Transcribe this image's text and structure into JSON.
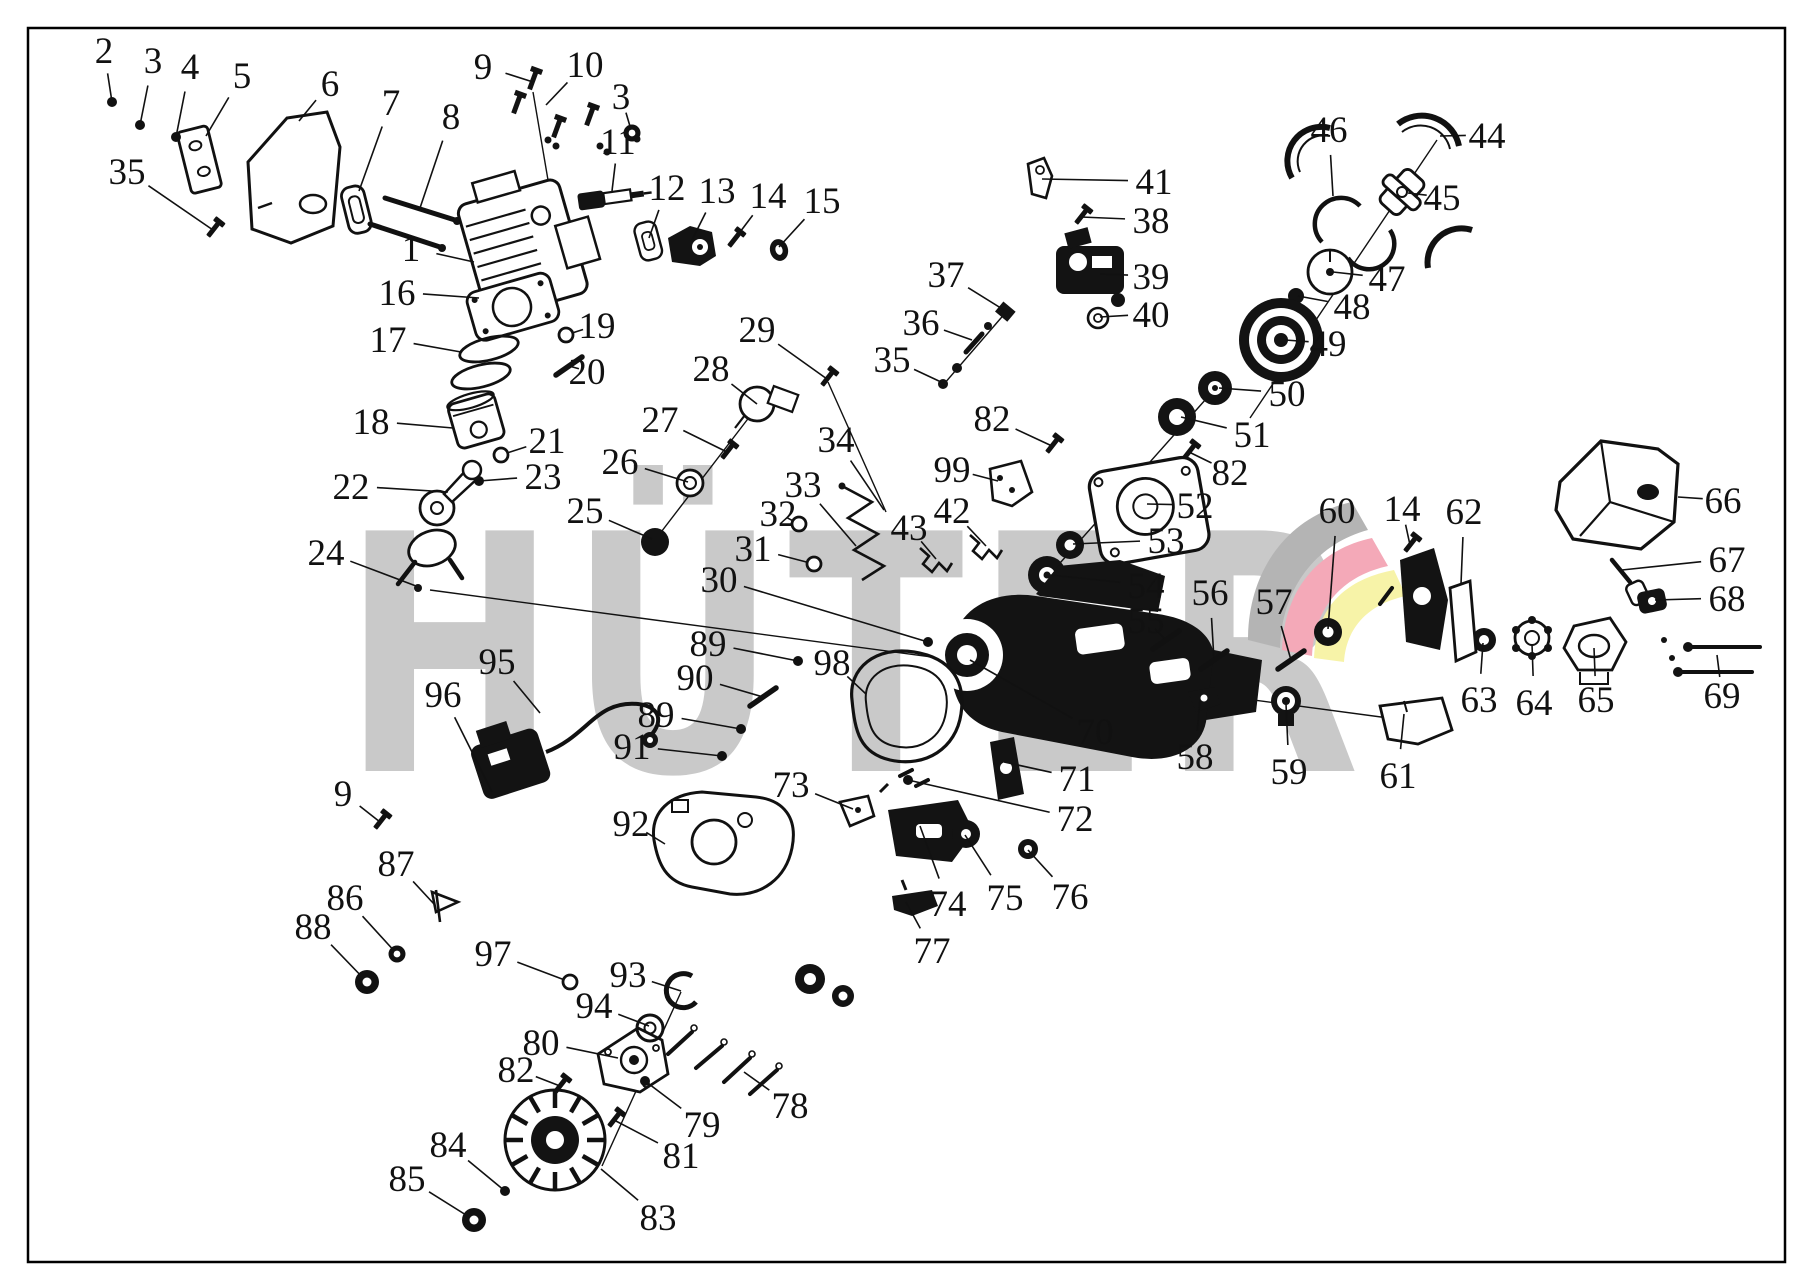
{
  "watermark": {
    "text": "HÜTER",
    "color": "#c9c9c9"
  },
  "logo": {
    "gray": "#b4b4b4",
    "pink": "#f4a9b8",
    "yellow": "#f7f3a8"
  },
  "frame": {
    "color": "#000000"
  },
  "ink": "#111111",
  "callouts": [
    {
      "n": "1",
      "x": 411,
      "y": 248,
      "tx": 474,
      "ty": 262,
      "g": "none"
    },
    {
      "n": "2",
      "x": 104,
      "y": 50,
      "tx": 112,
      "ty": 102,
      "g": "dot"
    },
    {
      "n": "3",
      "x": 153,
      "y": 60,
      "tx": 140,
      "ty": 125,
      "g": "dot"
    },
    {
      "n": "3",
      "x": 621,
      "y": 96,
      "tx": 632,
      "ty": 133,
      "g": "washer"
    },
    {
      "n": "4",
      "x": 190,
      "y": 66,
      "tx": 176,
      "ty": 137,
      "g": "dot"
    },
    {
      "n": "5",
      "x": 242,
      "y": 75,
      "tx": 206,
      "ty": 136,
      "g": "none"
    },
    {
      "n": "6",
      "x": 330,
      "y": 83,
      "tx": 299,
      "ty": 121,
      "g": "none"
    },
    {
      "n": "7",
      "x": 391,
      "y": 102,
      "tx": 359,
      "ty": 191,
      "g": "none"
    },
    {
      "n": "8",
      "x": 451,
      "y": 116,
      "tx": 420,
      "ty": 208,
      "g": "none"
    },
    {
      "n": "9",
      "x": 483,
      "y": 66,
      "tx": 533,
      "ty": 82,
      "g": "none"
    },
    {
      "n": "9",
      "x": 343,
      "y": 793,
      "tx": 380,
      "ty": 822,
      "g": "bolt"
    },
    {
      "n": "10",
      "x": 585,
      "y": 64,
      "tx": 546,
      "ty": 105,
      "g": "none"
    },
    {
      "n": "11",
      "x": 618,
      "y": 141,
      "tx": 612,
      "ty": 191,
      "g": "none"
    },
    {
      "n": "12",
      "x": 667,
      "y": 187,
      "tx": 649,
      "ty": 238,
      "g": "none"
    },
    {
      "n": "13",
      "x": 717,
      "y": 190,
      "tx": 692,
      "ty": 240,
      "g": "none"
    },
    {
      "n": "14",
      "x": 768,
      "y": 195,
      "tx": 734,
      "ty": 240,
      "g": "bolt"
    },
    {
      "n": "14",
      "x": 1402,
      "y": 508,
      "tx": 1410,
      "ty": 545,
      "g": "bolt"
    },
    {
      "n": "15",
      "x": 822,
      "y": 200,
      "tx": 779,
      "ty": 247,
      "g": "none"
    },
    {
      "n": "16",
      "x": 397,
      "y": 292,
      "tx": 479,
      "ty": 298,
      "g": "none"
    },
    {
      "n": "17",
      "x": 388,
      "y": 339,
      "tx": 461,
      "ty": 352,
      "g": "none"
    },
    {
      "n": "18",
      "x": 371,
      "y": 421,
      "tx": 453,
      "ty": 428,
      "g": "none"
    },
    {
      "n": "19",
      "x": 597,
      "y": 325,
      "tx": 566,
      "ty": 335,
      "g": "ring"
    },
    {
      "n": "20",
      "x": 587,
      "y": 371,
      "tx": 569,
      "ty": 366,
      "g": "rod"
    },
    {
      "n": "21",
      "x": 547,
      "y": 440,
      "tx": 501,
      "ty": 455,
      "g": "ring"
    },
    {
      "n": "22",
      "x": 351,
      "y": 486,
      "tx": 448,
      "ty": 492,
      "g": "none"
    },
    {
      "n": "23",
      "x": 543,
      "y": 476,
      "tx": 479,
      "ty": 481,
      "g": "dot"
    },
    {
      "n": "24",
      "x": 326,
      "y": 552,
      "tx": 416,
      "ty": 586,
      "g": "none"
    },
    {
      "n": "25",
      "x": 585,
      "y": 510,
      "tx": 652,
      "ty": 539,
      "g": "none"
    },
    {
      "n": "26",
      "x": 620,
      "y": 461,
      "tx": 688,
      "ty": 482,
      "g": "none"
    },
    {
      "n": "27",
      "x": 660,
      "y": 419,
      "tx": 727,
      "ty": 452,
      "g": "bolt"
    },
    {
      "n": "28",
      "x": 711,
      "y": 368,
      "tx": 757,
      "ty": 404,
      "g": "none"
    },
    {
      "n": "29",
      "x": 757,
      "y": 329,
      "tx": 827,
      "ty": 379,
      "g": "bolt"
    },
    {
      "n": "30",
      "x": 719,
      "y": 579,
      "tx": 928,
      "ty": 642,
      "g": "dot"
    },
    {
      "n": "31",
      "x": 753,
      "y": 548,
      "tx": 814,
      "ty": 564,
      "g": "ring"
    },
    {
      "n": "32",
      "x": 778,
      "y": 513,
      "tx": 799,
      "ty": 524,
      "g": "ring"
    },
    {
      "n": "33",
      "x": 803,
      "y": 484,
      "tx": 856,
      "ty": 546,
      "g": "none"
    },
    {
      "n": "34",
      "x": 836,
      "y": 439,
      "tx": 884,
      "ty": 510,
      "g": "none"
    },
    {
      "n": "35",
      "x": 127,
      "y": 171,
      "tx": 213,
      "ty": 230,
      "g": "bolt"
    },
    {
      "n": "35",
      "x": 892,
      "y": 359,
      "tx": 941,
      "ty": 382,
      "g": "none"
    },
    {
      "n": "36",
      "x": 921,
      "y": 322,
      "tx": 972,
      "ty": 340,
      "g": "none"
    },
    {
      "n": "37",
      "x": 946,
      "y": 274,
      "tx": 1004,
      "ty": 310,
      "g": "none"
    },
    {
      "n": "38",
      "x": 1151,
      "y": 220,
      "tx": 1081,
      "ty": 217,
      "g": "bolt"
    },
    {
      "n": "39",
      "x": 1151,
      "y": 276,
      "tx": 1100,
      "ty": 274,
      "g": "none"
    },
    {
      "n": "40",
      "x": 1151,
      "y": 314,
      "tx": 1100,
      "ty": 317,
      "g": "none"
    },
    {
      "n": "41",
      "x": 1154,
      "y": 181,
      "tx": 1042,
      "ty": 179,
      "g": "none"
    },
    {
      "n": "42",
      "x": 952,
      "y": 510,
      "tx": 986,
      "ty": 546,
      "g": "spring"
    },
    {
      "n": "43",
      "x": 909,
      "y": 527,
      "tx": 936,
      "ty": 559,
      "g": "spring"
    },
    {
      "n": "44",
      "x": 1487,
      "y": 135,
      "tx": 1440,
      "ty": 136,
      "g": "none"
    },
    {
      "n": "45",
      "x": 1442,
      "y": 197,
      "tx": 1408,
      "ty": 193,
      "g": "none"
    },
    {
      "n": "46",
      "x": 1329,
      "y": 129,
      "tx": 1333,
      "ty": 196,
      "g": "none"
    },
    {
      "n": "47",
      "x": 1387,
      "y": 278,
      "tx": 1333,
      "ty": 272,
      "g": "none"
    },
    {
      "n": "48",
      "x": 1352,
      "y": 306,
      "tx": 1298,
      "ty": 296,
      "g": "none"
    },
    {
      "n": "49",
      "x": 1328,
      "y": 343,
      "tx": 1285,
      "ty": 340,
      "g": "none"
    },
    {
      "n": "50",
      "x": 1287,
      "y": 393,
      "tx": 1219,
      "ty": 388,
      "g": "none"
    },
    {
      "n": "51",
      "x": 1252,
      "y": 434,
      "tx": 1181,
      "ty": 417,
      "g": "none"
    },
    {
      "n": "52",
      "x": 1195,
      "y": 505,
      "tx": 1147,
      "ty": 504,
      "g": "none"
    },
    {
      "n": "53",
      "x": 1166,
      "y": 540,
      "tx": 1073,
      "ty": 544,
      "g": "none"
    },
    {
      "n": "54",
      "x": 1146,
      "y": 585,
      "tx": 1050,
      "ty": 575,
      "g": "none"
    },
    {
      "n": "55",
      "x": 1146,
      "y": 620,
      "tx": 1166,
      "ty": 640,
      "g": "rod"
    },
    {
      "n": "56",
      "x": 1210,
      "y": 592,
      "tx": 1214,
      "ty": 660,
      "g": "rod"
    },
    {
      "n": "57",
      "x": 1274,
      "y": 601,
      "tx": 1291,
      "ty": 660,
      "g": "rod"
    },
    {
      "n": "58",
      "x": 1195,
      "y": 756,
      "tx": 1200,
      "ty": 700,
      "g": "none"
    },
    {
      "n": "59",
      "x": 1289,
      "y": 771,
      "tx": 1286,
      "ty": 704,
      "g": "none"
    },
    {
      "n": "60",
      "x": 1337,
      "y": 510,
      "tx": 1328,
      "ty": 629,
      "g": "none"
    },
    {
      "n": "61",
      "x": 1398,
      "y": 775,
      "tx": 1404,
      "ty": 714,
      "g": "none"
    },
    {
      "n": "62",
      "x": 1464,
      "y": 511,
      "tx": 1461,
      "ty": 584,
      "g": "none"
    },
    {
      "n": "63",
      "x": 1479,
      "y": 699,
      "tx": 1483,
      "ty": 643,
      "g": "none"
    },
    {
      "n": "64",
      "x": 1534,
      "y": 702,
      "tx": 1532,
      "ty": 644,
      "g": "none"
    },
    {
      "n": "65",
      "x": 1596,
      "y": 699,
      "tx": 1594,
      "ty": 648,
      "g": "none"
    },
    {
      "n": "66",
      "x": 1723,
      "y": 500,
      "tx": 1678,
      "ty": 497,
      "g": "none"
    },
    {
      "n": "67",
      "x": 1727,
      "y": 559,
      "tx": 1622,
      "ty": 570,
      "g": "none"
    },
    {
      "n": "68",
      "x": 1727,
      "y": 598,
      "tx": 1655,
      "ty": 600,
      "g": "none"
    },
    {
      "n": "69",
      "x": 1722,
      "y": 695,
      "tx": 1717,
      "ty": 655,
      "g": "none"
    },
    {
      "n": "70",
      "x": 1095,
      "y": 731,
      "tx": 970,
      "ty": 660,
      "g": "none"
    },
    {
      "n": "71",
      "x": 1077,
      "y": 778,
      "tx": 1004,
      "ty": 762,
      "g": "none"
    },
    {
      "n": "72",
      "x": 1075,
      "y": 818,
      "tx": 908,
      "ty": 780,
      "g": "dot"
    },
    {
      "n": "73",
      "x": 791,
      "y": 784,
      "tx": 853,
      "ty": 809,
      "g": "none"
    },
    {
      "n": "74",
      "x": 948,
      "y": 903,
      "tx": 920,
      "ty": 826,
      "g": "none"
    },
    {
      "n": "75",
      "x": 1005,
      "y": 897,
      "tx": 965,
      "ty": 835,
      "g": "none"
    },
    {
      "n": "76",
      "x": 1070,
      "y": 896,
      "tx": 1028,
      "ty": 850,
      "g": "none"
    },
    {
      "n": "77",
      "x": 932,
      "y": 950,
      "tx": 906,
      "ty": 902,
      "g": "none"
    },
    {
      "n": "78",
      "x": 790,
      "y": 1105,
      "tx": 744,
      "ty": 1072,
      "g": "none"
    },
    {
      "n": "79",
      "x": 702,
      "y": 1124,
      "tx": 645,
      "ty": 1081,
      "g": "dot"
    },
    {
      "n": "80",
      "x": 541,
      "y": 1042,
      "tx": 618,
      "ty": 1058,
      "g": "none"
    },
    {
      "n": "81",
      "x": 681,
      "y": 1155,
      "tx": 614,
      "ty": 1120,
      "g": "bolt"
    },
    {
      "n": "82",
      "x": 992,
      "y": 418,
      "tx": 1052,
      "ty": 446,
      "g": "bolt"
    },
    {
      "n": "82",
      "x": 1230,
      "y": 472,
      "tx": 1189,
      "ty": 452,
      "g": "bolt"
    },
    {
      "n": "82",
      "x": 516,
      "y": 1069,
      "tx": 560,
      "ty": 1086,
      "g": "bolt"
    },
    {
      "n": "83",
      "x": 658,
      "y": 1217,
      "tx": 601,
      "ty": 1169,
      "g": "none"
    },
    {
      "n": "84",
      "x": 448,
      "y": 1144,
      "tx": 505,
      "ty": 1191,
      "g": "dot"
    },
    {
      "n": "85",
      "x": 407,
      "y": 1178,
      "tx": 474,
      "ty": 1220,
      "g": "disc"
    },
    {
      "n": "86",
      "x": 345,
      "y": 897,
      "tx": 397,
      "ty": 954,
      "g": "washer"
    },
    {
      "n": "87",
      "x": 396,
      "y": 863,
      "tx": 434,
      "ty": 904,
      "g": "none"
    },
    {
      "n": "88",
      "x": 313,
      "y": 926,
      "tx": 367,
      "ty": 982,
      "g": "disc"
    },
    {
      "n": "89",
      "x": 708,
      "y": 643,
      "tx": 798,
      "ty": 661,
      "g": "dot"
    },
    {
      "n": "89",
      "x": 656,
      "y": 714,
      "tx": 741,
      "ty": 729,
      "g": "dot"
    },
    {
      "n": "90",
      "x": 695,
      "y": 677,
      "tx": 763,
      "ty": 697,
      "g": "rod"
    },
    {
      "n": "91",
      "x": 632,
      "y": 746,
      "tx": 722,
      "ty": 756,
      "g": "dot"
    },
    {
      "n": "92",
      "x": 631,
      "y": 823,
      "tx": 665,
      "ty": 844,
      "g": "none"
    },
    {
      "n": "93",
      "x": 628,
      "y": 974,
      "tx": 681,
      "ty": 991,
      "g": "none"
    },
    {
      "n": "94",
      "x": 594,
      "y": 1005,
      "tx": 649,
      "ty": 1026,
      "g": "none"
    },
    {
      "n": "95",
      "x": 497,
      "y": 661,
      "tx": 540,
      "ty": 713,
      "g": "none"
    },
    {
      "n": "96",
      "x": 443,
      "y": 694,
      "tx": 492,
      "ty": 792,
      "g": "none"
    },
    {
      "n": "97",
      "x": 493,
      "y": 953,
      "tx": 570,
      "ty": 982,
      "g": "ring"
    },
    {
      "n": "98",
      "x": 832,
      "y": 662,
      "tx": 866,
      "ty": 694,
      "g": "none"
    },
    {
      "n": "99",
      "x": 952,
      "y": 469,
      "tx": 998,
      "ty": 481,
      "g": "none"
    }
  ]
}
